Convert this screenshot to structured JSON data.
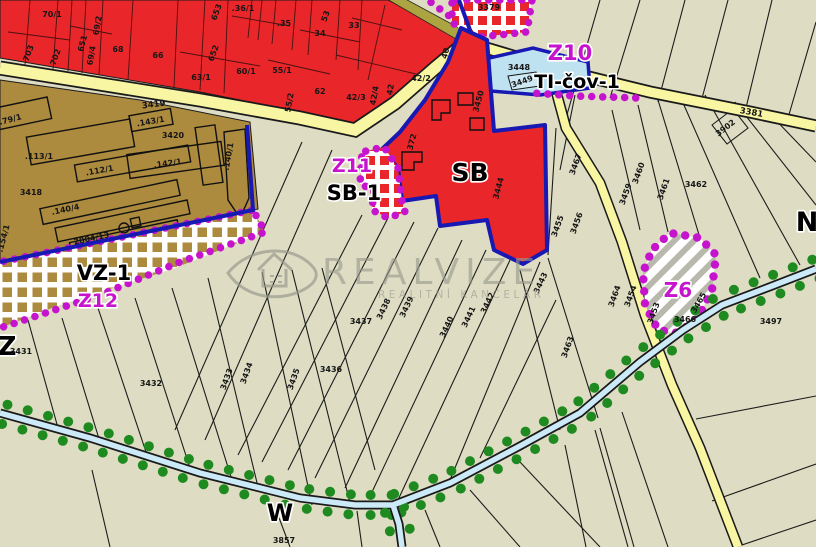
{
  "map": {
    "colors": {
      "beige": "#DEDDC3",
      "red": "#E92629",
      "brown": "#AC8A3E",
      "olive": "#ABA441",
      "roadYellow": "#F9F6A3",
      "roadEdge": "#1a1a1a",
      "lightBlue": "#BFE2F1",
      "lightBlueInner": "#CFE9F4",
      "streamBlue": "#CBE9F6",
      "navy": "#1818B2",
      "magenta": "#C614CE",
      "greenDot": "#1E8A1F",
      "hatchGray": "#B9B8AC",
      "white": "#FFFFFF",
      "watermarkGray": "#98988E"
    },
    "watermark": {
      "brand": "REALVIZE",
      "subtitle": "REALITNÍ KANCELÁŘ"
    },
    "labels": [
      {
        "text": "Z10",
        "x": 570,
        "y": 60,
        "kind": "zone-magenta",
        "size": 21
      },
      {
        "text": "TI-čov-1",
        "x": 577,
        "y": 88,
        "kind": "zone-black",
        "size": 19
      },
      {
        "text": "Z11",
        "x": 352,
        "y": 172,
        "kind": "zone-magenta",
        "size": 19
      },
      {
        "text": "SB-1",
        "x": 354,
        "y": 200,
        "kind": "zone-black",
        "size": 21
      },
      {
        "text": "SB",
        "x": 470,
        "y": 181,
        "kind": "zone-black",
        "size": 25
      },
      {
        "text": "VZ-1",
        "x": 104,
        "y": 280,
        "kind": "zone-black",
        "size": 21
      },
      {
        "text": "Z12",
        "x": 98,
        "y": 307,
        "kind": "zone-magenta",
        "size": 19
      },
      {
        "text": "Z6",
        "x": 678,
        "y": 297,
        "kind": "zone-magenta",
        "size": 20
      },
      {
        "text": "Z",
        "x": 7,
        "y": 355,
        "kind": "zone-black",
        "size": 26
      },
      {
        "text": "W",
        "x": 280,
        "y": 521,
        "kind": "zone-black",
        "size": 24
      },
      {
        "text": "N",
        "x": 807,
        "y": 231,
        "kind": "zone-black",
        "size": 27
      },
      {
        "text": "3419",
        "x": 154,
        "y": 107,
        "kind": "road",
        "r": -7
      },
      {
        "text": "3381",
        "x": 751,
        "y": 115,
        "kind": "road",
        "r": 10
      },
      {
        "text": "70/1",
        "x": 52,
        "y": 17,
        "kind": "parcel"
      },
      {
        "text": "703",
        "x": 31,
        "y": 54,
        "kind": "parcel",
        "r": -70
      },
      {
        "text": "702",
        "x": 58,
        "y": 58,
        "kind": "parcel",
        "r": -70
      },
      {
        "text": "651",
        "x": 85,
        "y": 44,
        "kind": "parcel",
        "r": -75
      },
      {
        "text": "69/2",
        "x": 100,
        "y": 26,
        "kind": "parcel",
        "r": -80
      },
      {
        "text": "69/4",
        "x": 94,
        "y": 56,
        "kind": "parcel",
        "r": -80
      },
      {
        "text": "68",
        "x": 118,
        "y": 52,
        "kind": "parcel"
      },
      {
        "text": "66",
        "x": 158,
        "y": 58,
        "kind": "parcel"
      },
      {
        "text": "63/1",
        "x": 201,
        "y": 80,
        "kind": "parcel"
      },
      {
        "text": "60/1",
        "x": 246,
        "y": 74,
        "kind": "parcel"
      },
      {
        "text": ".36/1",
        "x": 243,
        "y": 11,
        "kind": "parcel"
      },
      {
        "text": "653",
        "x": 219,
        "y": 13,
        "kind": "parcel",
        "r": -70
      },
      {
        "text": "652",
        "x": 216,
        "y": 54,
        "kind": "parcel",
        "r": -70
      },
      {
        "text": ".35",
        "x": 284,
        "y": 26,
        "kind": "parcel"
      },
      {
        "text": "53",
        "x": 328,
        "y": 17,
        "kind": "parcel",
        "r": -70
      },
      {
        "text": "34",
        "x": 320,
        "y": 36,
        "kind": "parcel"
      },
      {
        "text": "33",
        "x": 354,
        "y": 28,
        "kind": "parcel"
      },
      {
        "text": "55/1",
        "x": 282,
        "y": 73,
        "kind": "parcel"
      },
      {
        "text": "55/2",
        "x": 292,
        "y": 103,
        "kind": "parcel",
        "r": -80
      },
      {
        "text": "62",
        "x": 320,
        "y": 94,
        "kind": "parcel"
      },
      {
        "text": "42/3",
        "x": 356,
        "y": 100,
        "kind": "parcel"
      },
      {
        "text": "42/4",
        "x": 377,
        "y": 96,
        "kind": "parcel",
        "r": -80
      },
      {
        "text": "42",
        "x": 393,
        "y": 90,
        "kind": "parcel",
        "r": -80
      },
      {
        "text": "42/2",
        "x": 421,
        "y": 81,
        "kind": "parcel"
      },
      {
        "text": "40",
        "x": 448,
        "y": 54,
        "kind": "parcel",
        "r": -75
      },
      {
        "text": "3450",
        "x": 481,
        "y": 102,
        "kind": "parcel",
        "r": -75
      },
      {
        "text": ".372",
        "x": 414,
        "y": 144,
        "kind": "parcel",
        "r": -75
      },
      {
        "text": "3444",
        "x": 501,
        "y": 189,
        "kind": "parcel",
        "r": -75
      },
      {
        "text": ".79/1",
        "x": 11,
        "y": 122,
        "kind": "parcel",
        "r": -15
      },
      {
        "text": ".113/1",
        "x": 39,
        "y": 159,
        "kind": "parcel"
      },
      {
        "text": ".112/1",
        "x": 100,
        "y": 173,
        "kind": "parcel",
        "r": -10
      },
      {
        "text": ".143/1",
        "x": 151,
        "y": 124,
        "kind": "parcel",
        "r": -10
      },
      {
        "text": "3420",
        "x": 173,
        "y": 138,
        "kind": "parcel"
      },
      {
        "text": ".142/1",
        "x": 168,
        "y": 166,
        "kind": "parcel",
        "r": -8
      },
      {
        "text": ".140/1",
        "x": 231,
        "y": 157,
        "kind": "parcel",
        "r": -80
      },
      {
        "text": "3418",
        "x": 31,
        "y": 195,
        "kind": "parcel"
      },
      {
        "text": ".140/4",
        "x": 66,
        "y": 212,
        "kind": "parcel",
        "r": -12
      },
      {
        "text": "2804/13",
        "x": 92,
        "y": 241,
        "kind": "parcel",
        "r": -12
      },
      {
        "text": ".154/1",
        "x": 6,
        "y": 239,
        "kind": "parcel",
        "r": -75
      },
      {
        "text": "3448",
        "x": 519,
        "y": 70,
        "kind": "parcel"
      },
      {
        "text": "3449",
        "x": 523,
        "y": 84,
        "kind": "parcel",
        "r": -20
      },
      {
        "text": "3379",
        "x": 489,
        "y": 10,
        "kind": "parcel"
      },
      {
        "text": "3902",
        "x": 727,
        "y": 130,
        "kind": "parcel",
        "r": -38
      },
      {
        "text": "3437",
        "x": 361,
        "y": 324,
        "kind": "parcel"
      },
      {
        "text": "3438",
        "x": 386,
        "y": 310,
        "kind": "parcel",
        "r": -65
      },
      {
        "text": "3439",
        "x": 409,
        "y": 308,
        "kind": "parcel",
        "r": -65
      },
      {
        "text": "3440",
        "x": 449,
        "y": 328,
        "kind": "parcel",
        "r": -65
      },
      {
        "text": "3441",
        "x": 471,
        "y": 318,
        "kind": "parcel",
        "r": -65
      },
      {
        "text": "3442",
        "x": 490,
        "y": 304,
        "kind": "parcel",
        "r": -65
      },
      {
        "text": "3443",
        "x": 543,
        "y": 284,
        "kind": "parcel",
        "r": -65
      },
      {
        "text": "3431",
        "x": 21,
        "y": 354,
        "kind": "parcel"
      },
      {
        "text": "3432",
        "x": 151,
        "y": 386,
        "kind": "parcel"
      },
      {
        "text": "3433",
        "x": 229,
        "y": 380,
        "kind": "parcel",
        "r": -70
      },
      {
        "text": "3434",
        "x": 249,
        "y": 374,
        "kind": "parcel",
        "r": -70
      },
      {
        "text": "3435",
        "x": 296,
        "y": 380,
        "kind": "parcel",
        "r": -70
      },
      {
        "text": "3436",
        "x": 331,
        "y": 372,
        "kind": "parcel"
      },
      {
        "text": "3467",
        "x": 578,
        "y": 165,
        "kind": "parcel",
        "r": -70
      },
      {
        "text": "3460",
        "x": 641,
        "y": 174,
        "kind": "parcel",
        "r": -70
      },
      {
        "text": "3461",
        "x": 666,
        "y": 190,
        "kind": "parcel",
        "r": -70
      },
      {
        "text": "3462",
        "x": 696,
        "y": 187,
        "kind": "parcel"
      },
      {
        "text": "3459",
        "x": 628,
        "y": 195,
        "kind": "parcel",
        "r": -70
      },
      {
        "text": "3455",
        "x": 560,
        "y": 227,
        "kind": "parcel",
        "r": -70
      },
      {
        "text": "3456",
        "x": 579,
        "y": 224,
        "kind": "parcel",
        "r": -70
      },
      {
        "text": "3453",
        "x": 656,
        "y": 314,
        "kind": "parcel",
        "r": -70
      },
      {
        "text": "3454",
        "x": 633,
        "y": 297,
        "kind": "parcel",
        "r": -70
      },
      {
        "text": "3463",
        "x": 570,
        "y": 348,
        "kind": "parcel",
        "r": -70
      },
      {
        "text": "3464",
        "x": 617,
        "y": 297,
        "kind": "parcel",
        "r": -70
      },
      {
        "text": "3465",
        "x": 701,
        "y": 304,
        "kind": "parcel",
        "r": -60
      },
      {
        "text": "3466",
        "x": 685,
        "y": 322,
        "kind": "parcel"
      },
      {
        "text": "3497",
        "x": 771,
        "y": 324,
        "kind": "parcel"
      },
      {
        "text": "3857",
        "x": 284,
        "y": 543,
        "kind": "parcel"
      }
    ]
  }
}
